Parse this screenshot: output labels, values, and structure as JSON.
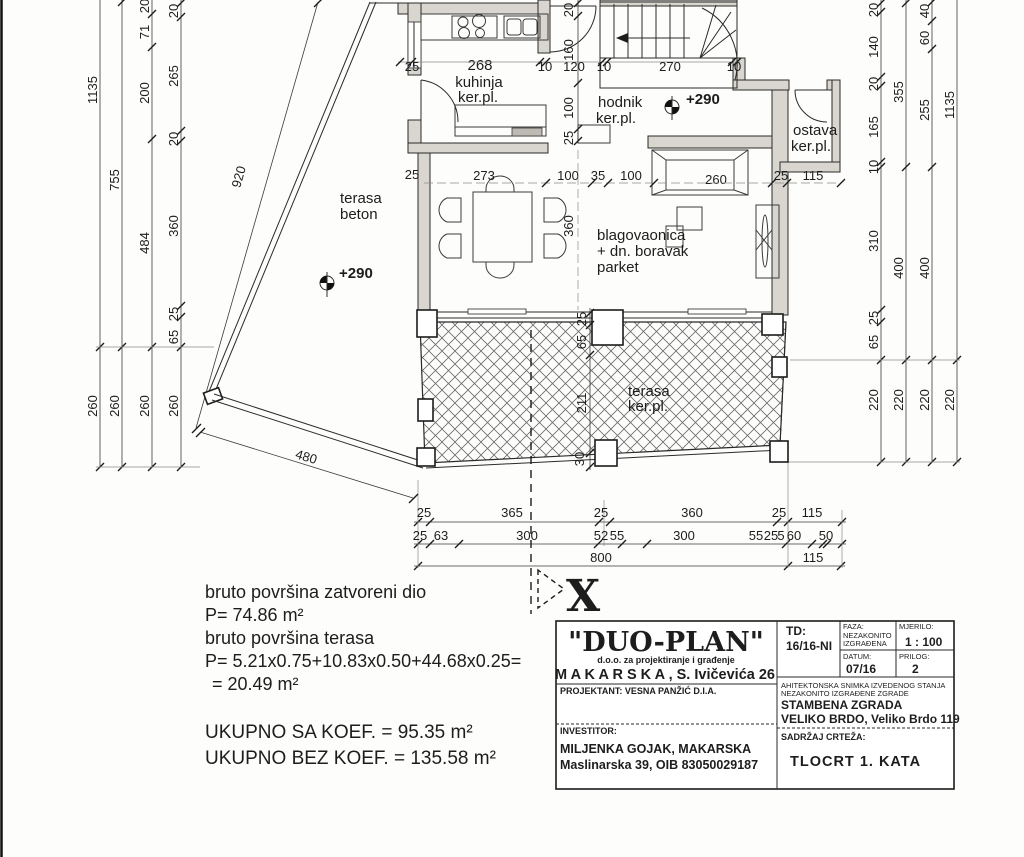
{
  "plan": {
    "rooms": {
      "kuhinja": {
        "number": "268",
        "name": "kuhinja",
        "floor": "ker.pl."
      },
      "hodnik": {
        "name": "hodnik",
        "floor": "ker.pl."
      },
      "ostava": {
        "name": "ostava",
        "floor": "ker.pl."
      },
      "living": {
        "line1": "blagovaonica",
        "line2": "+ dn. boravak",
        "line3": "parket"
      },
      "terasa_beton": {
        "line1": "terasa",
        "line2": "beton"
      },
      "terasa_ker": {
        "line1": "terasa",
        "line2": "ker.pl."
      }
    },
    "levels": {
      "terrace": "+290",
      "hall": "+290"
    },
    "section": {
      "label": "X"
    },
    "dims": {
      "left1": [
        "1135",
        "260"
      ],
      "left2": [
        "755",
        "260"
      ],
      "left3": [
        "20",
        "71",
        "200",
        "484",
        "260"
      ],
      "left4": [
        "20",
        "265",
        "20",
        "360",
        "25",
        "65",
        "260"
      ],
      "right1": [
        "20",
        "140",
        "20",
        "165",
        "10",
        "310",
        "25",
        "65",
        "220"
      ],
      "right2": [
        "355",
        "400",
        "220"
      ],
      "right3": [
        "40",
        "60",
        "255",
        "400",
        "220"
      ],
      "right4": [
        "1135",
        "220"
      ],
      "hall_v": [
        "20",
        "160",
        "100",
        "25"
      ],
      "top_h": [
        "25",
        "10",
        "120",
        "10",
        "270",
        "10"
      ],
      "room_h": [
        "25",
        "273",
        "100",
        "35",
        "100",
        "25",
        "115"
      ],
      "sofa": "260",
      "room_v": "360",
      "terr_v": [
        "25",
        "65",
        "211",
        "30"
      ],
      "bottom1": [
        "25",
        "365",
        "25",
        "360",
        "25",
        "115"
      ],
      "bottom2": [
        "25",
        "63",
        "300",
        "52",
        "55",
        "300",
        "55",
        "25",
        "5",
        "60",
        "50"
      ],
      "bottom3": [
        "800",
        "115"
      ],
      "diag_left": "920",
      "diag_bottom": "480"
    }
  },
  "notes": {
    "l1": "bruto površina zatvoreni dio",
    "l2": "P= 74.86 m²",
    "l3": "bruto površina terasa",
    "l4": "P= 5.21x0.75+10.83x0.50+44.68x0.25=",
    "l5": "= 20.49 m²",
    "l6": "UKUPNO SA KOEF. = 95.35 m²",
    "l7": "UKUPNO BEZ KOEF. = 135.58 m²"
  },
  "title_block": {
    "company": "\"DUO-PLAN\"",
    "company_sub": "d.o.o. za projektiranje i građenje",
    "company_city": "M A K A R S K A , S. Ivičevića 26",
    "projektant": "PROJEKTANT: VESNA PANŽIĆ D.I.A.",
    "investitor_label": "INVESTITOR:",
    "investitor_name": "MILJENKA GOJAK, MAKARSKA",
    "investitor_addr": "Maslinarska 39, OIB 83050029187",
    "td_label": "TD:",
    "td": "16/16-NI",
    "faza_label": "FAZA:",
    "faza1": "NEZAKONITO",
    "faza2": "IZGRAĐENA",
    "mjerilo_label": "MJERILO:",
    "mjerilo": "1 : 100",
    "datum_label": "DATUM:",
    "datum": "07/16",
    "prilog_label": "PRILOG:",
    "prilog": "2",
    "desc1": "AHITEKTONSKA SNIMKA IZVEDENOG STANJA",
    "desc2": "NEZAKONITO IZGRAĐENE ZGRADE",
    "building": "STAMBENA ZGRADA",
    "location": "VELIKO BRDO, Veliko Brdo 119",
    "sadrzaj_label": "SADRŽAJ CRTEŽA:",
    "drawing": "TLOCRT 1. KATA"
  }
}
